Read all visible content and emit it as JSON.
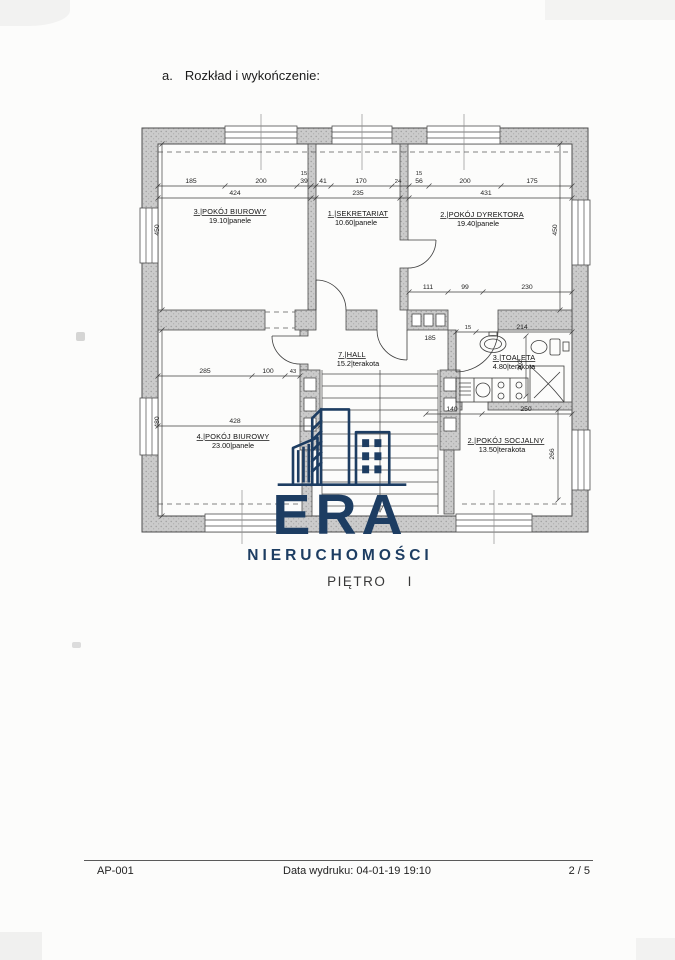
{
  "page": {
    "header": {
      "index": "a.",
      "title": "Rozkład i wykończenie:"
    },
    "caption": "PIĘTRO I",
    "footer": {
      "doc_id": "AP-001",
      "print_date": "Data wydruku: 04-01-19 19:10",
      "page_num": "2 / 5"
    }
  },
  "logo": {
    "brand": "ERA",
    "subtitle": "NIERUCHOMOŚCI",
    "color": "#1d3d62"
  },
  "plan": {
    "type": "floor-plan",
    "wall_color": "#c9c9c9",
    "line_color": "#3e3e3e",
    "fixtures": [
      "stairs",
      "sink",
      "toilet",
      "shower",
      "kitchenette",
      "chimney-flues",
      "windows",
      "doors"
    ],
    "rooms": [
      {
        "name": "3.|POKÓJ BIUROWY",
        "area": "19.10|panele"
      },
      {
        "name": "1.|SEKRETARIAT",
        "area": "10.60|panele"
      },
      {
        "name": "2.|POKÓJ DYREKTORA",
        "area": "19.40|panele"
      },
      {
        "name": "7.|HALL",
        "area": "15.2|terakota"
      },
      {
        "name": "3.|TOALETA",
        "area": "4.80|terakota"
      },
      {
        "name": "4.|POKÓJ BIUROWY",
        "area": "23.00|panele"
      },
      {
        "name": "2.|POKÓJ SOCJALNY",
        "area": "13.50|terakota"
      }
    ],
    "dims": [
      "185",
      "200",
      "15",
      "39",
      "41",
      "170",
      "24",
      "15",
      "56",
      "200",
      "175",
      "424",
      "235",
      "431",
      "450",
      "450",
      "111",
      "99",
      "230",
      "185",
      "15",
      "214",
      "202",
      "285",
      "100",
      "43",
      "428",
      "480",
      "140",
      "250",
      "266"
    ]
  }
}
